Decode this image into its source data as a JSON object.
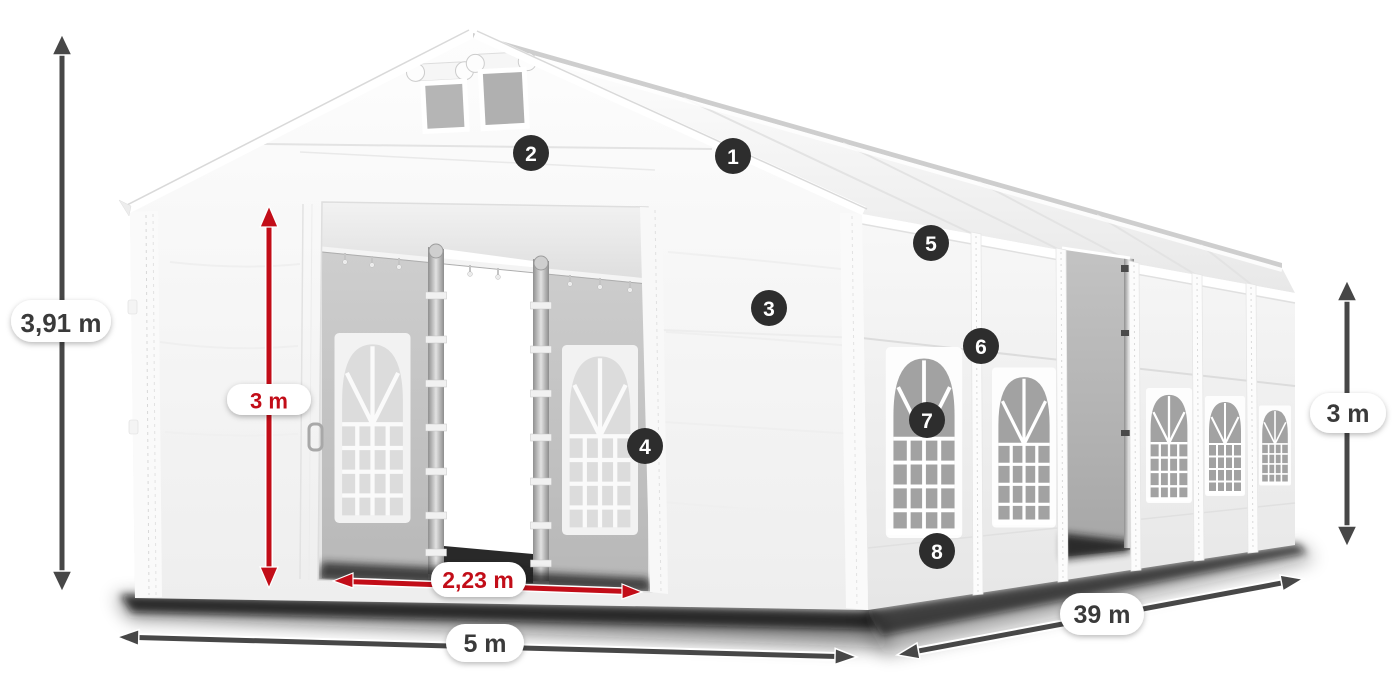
{
  "diagram": {
    "subject": "White party marquee tent with open front entrance doors, side wall windows and dimension annotations",
    "dimensions": {
      "total_height": "3,91 m",
      "entrance_height": "3 m",
      "entrance_width": "2,23 m",
      "front_width": "5 m",
      "length": "39 m",
      "side_wall_height": "3 m"
    },
    "callouts": [
      {
        "number": "1"
      },
      {
        "number": "2"
      },
      {
        "number": "3"
      },
      {
        "number": "4"
      },
      {
        "number": "5"
      },
      {
        "number": "6"
      },
      {
        "number": "7"
      },
      {
        "number": "8"
      }
    ],
    "colors": {
      "arrow_gray": "#474747",
      "arrow_red": "#c20d18",
      "label_text_gray": "#3a3a3a",
      "label_text_red": "#c20d18",
      "label_pill_bg": "#ffffff",
      "badge_bg": "#2d2d2d",
      "badge_text": "#ffffff",
      "canvas_bg": "#ffffff"
    }
  }
}
